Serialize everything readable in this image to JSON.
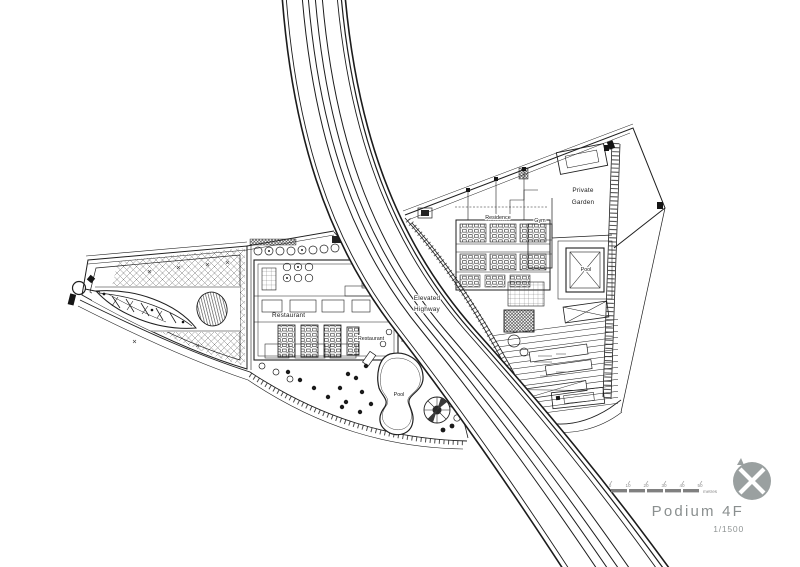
{
  "drawing": {
    "type": "architectural-site-plan",
    "labels": {
      "restaurant": "Restaurant",
      "restaurant_2": "Restaurant",
      "pool_landscape": "Pool",
      "pool_residence": "Pool",
      "residence": "Residence",
      "gym": "Gym",
      "private_garden_l1": "Private",
      "private_garden_l2": "Garden",
      "highway_l1": "Elevated",
      "highway_l2": "Highway"
    }
  },
  "scale_bar": {
    "ticks": [
      "0",
      "10",
      "20",
      "30",
      "40",
      "50"
    ],
    "unit": "metres"
  },
  "title_block": {
    "title": "Podium 4F",
    "scale": "1/1500"
  },
  "icons": {
    "north": "compass-north-icon"
  },
  "colors": {
    "ink": "#1f1f1f",
    "muted_gray": "#8a8f8f",
    "north_icon_gray": "#9aa0a0",
    "scale_bar_gray": "#808080"
  }
}
